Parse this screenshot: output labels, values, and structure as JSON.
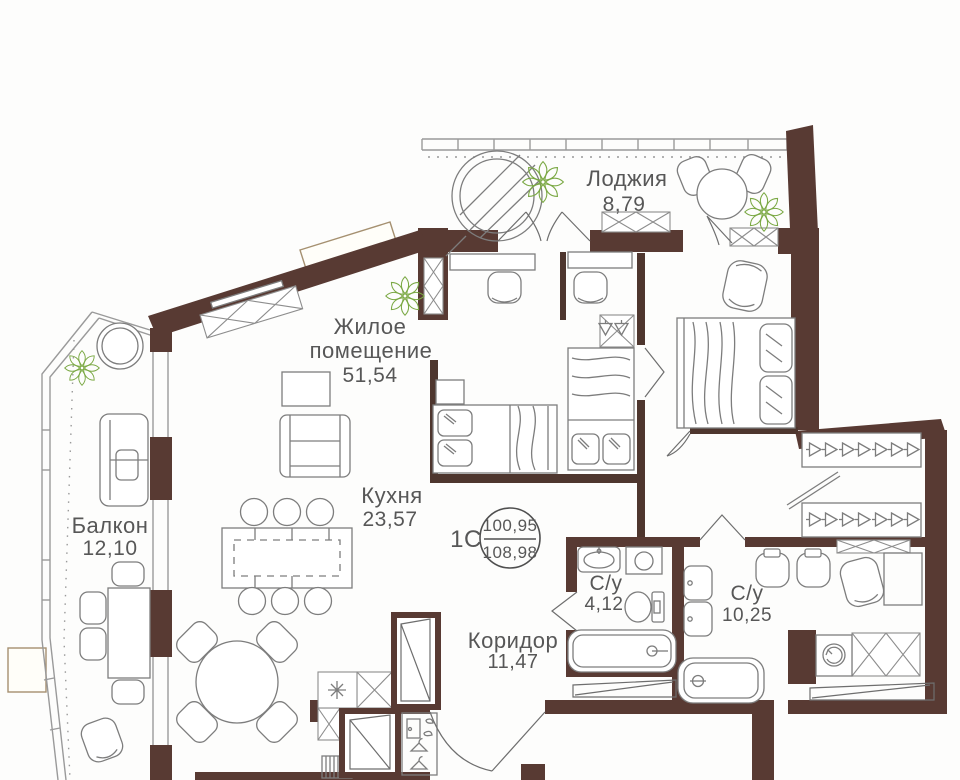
{
  "plan": {
    "apartment": {
      "code": "1С",
      "area_living": "100,95",
      "area_total": "108,98"
    },
    "rooms": [
      {
        "id": "loggia",
        "label": "Лоджия",
        "area": "8,79"
      },
      {
        "id": "living",
        "label": "Жилое помещение",
        "line1": "Жилое",
        "line2": "помещение",
        "area": "51,54"
      },
      {
        "id": "kitchen",
        "label": "Кухня",
        "area": "23,57"
      },
      {
        "id": "balcony",
        "label": "Балкон",
        "area": "12,10"
      },
      {
        "id": "bathroom_small",
        "label": "С/у",
        "area": "4,12"
      },
      {
        "id": "bathroom_large",
        "label": "С/у",
        "area": "10,25"
      },
      {
        "id": "corridor",
        "label": "Коридор",
        "area": "11,47"
      }
    ],
    "colors": {
      "wall": "#583a33",
      "furniture_line": "#7d7d7d",
      "plant": "#7aa843",
      "text": "#575757"
    }
  }
}
